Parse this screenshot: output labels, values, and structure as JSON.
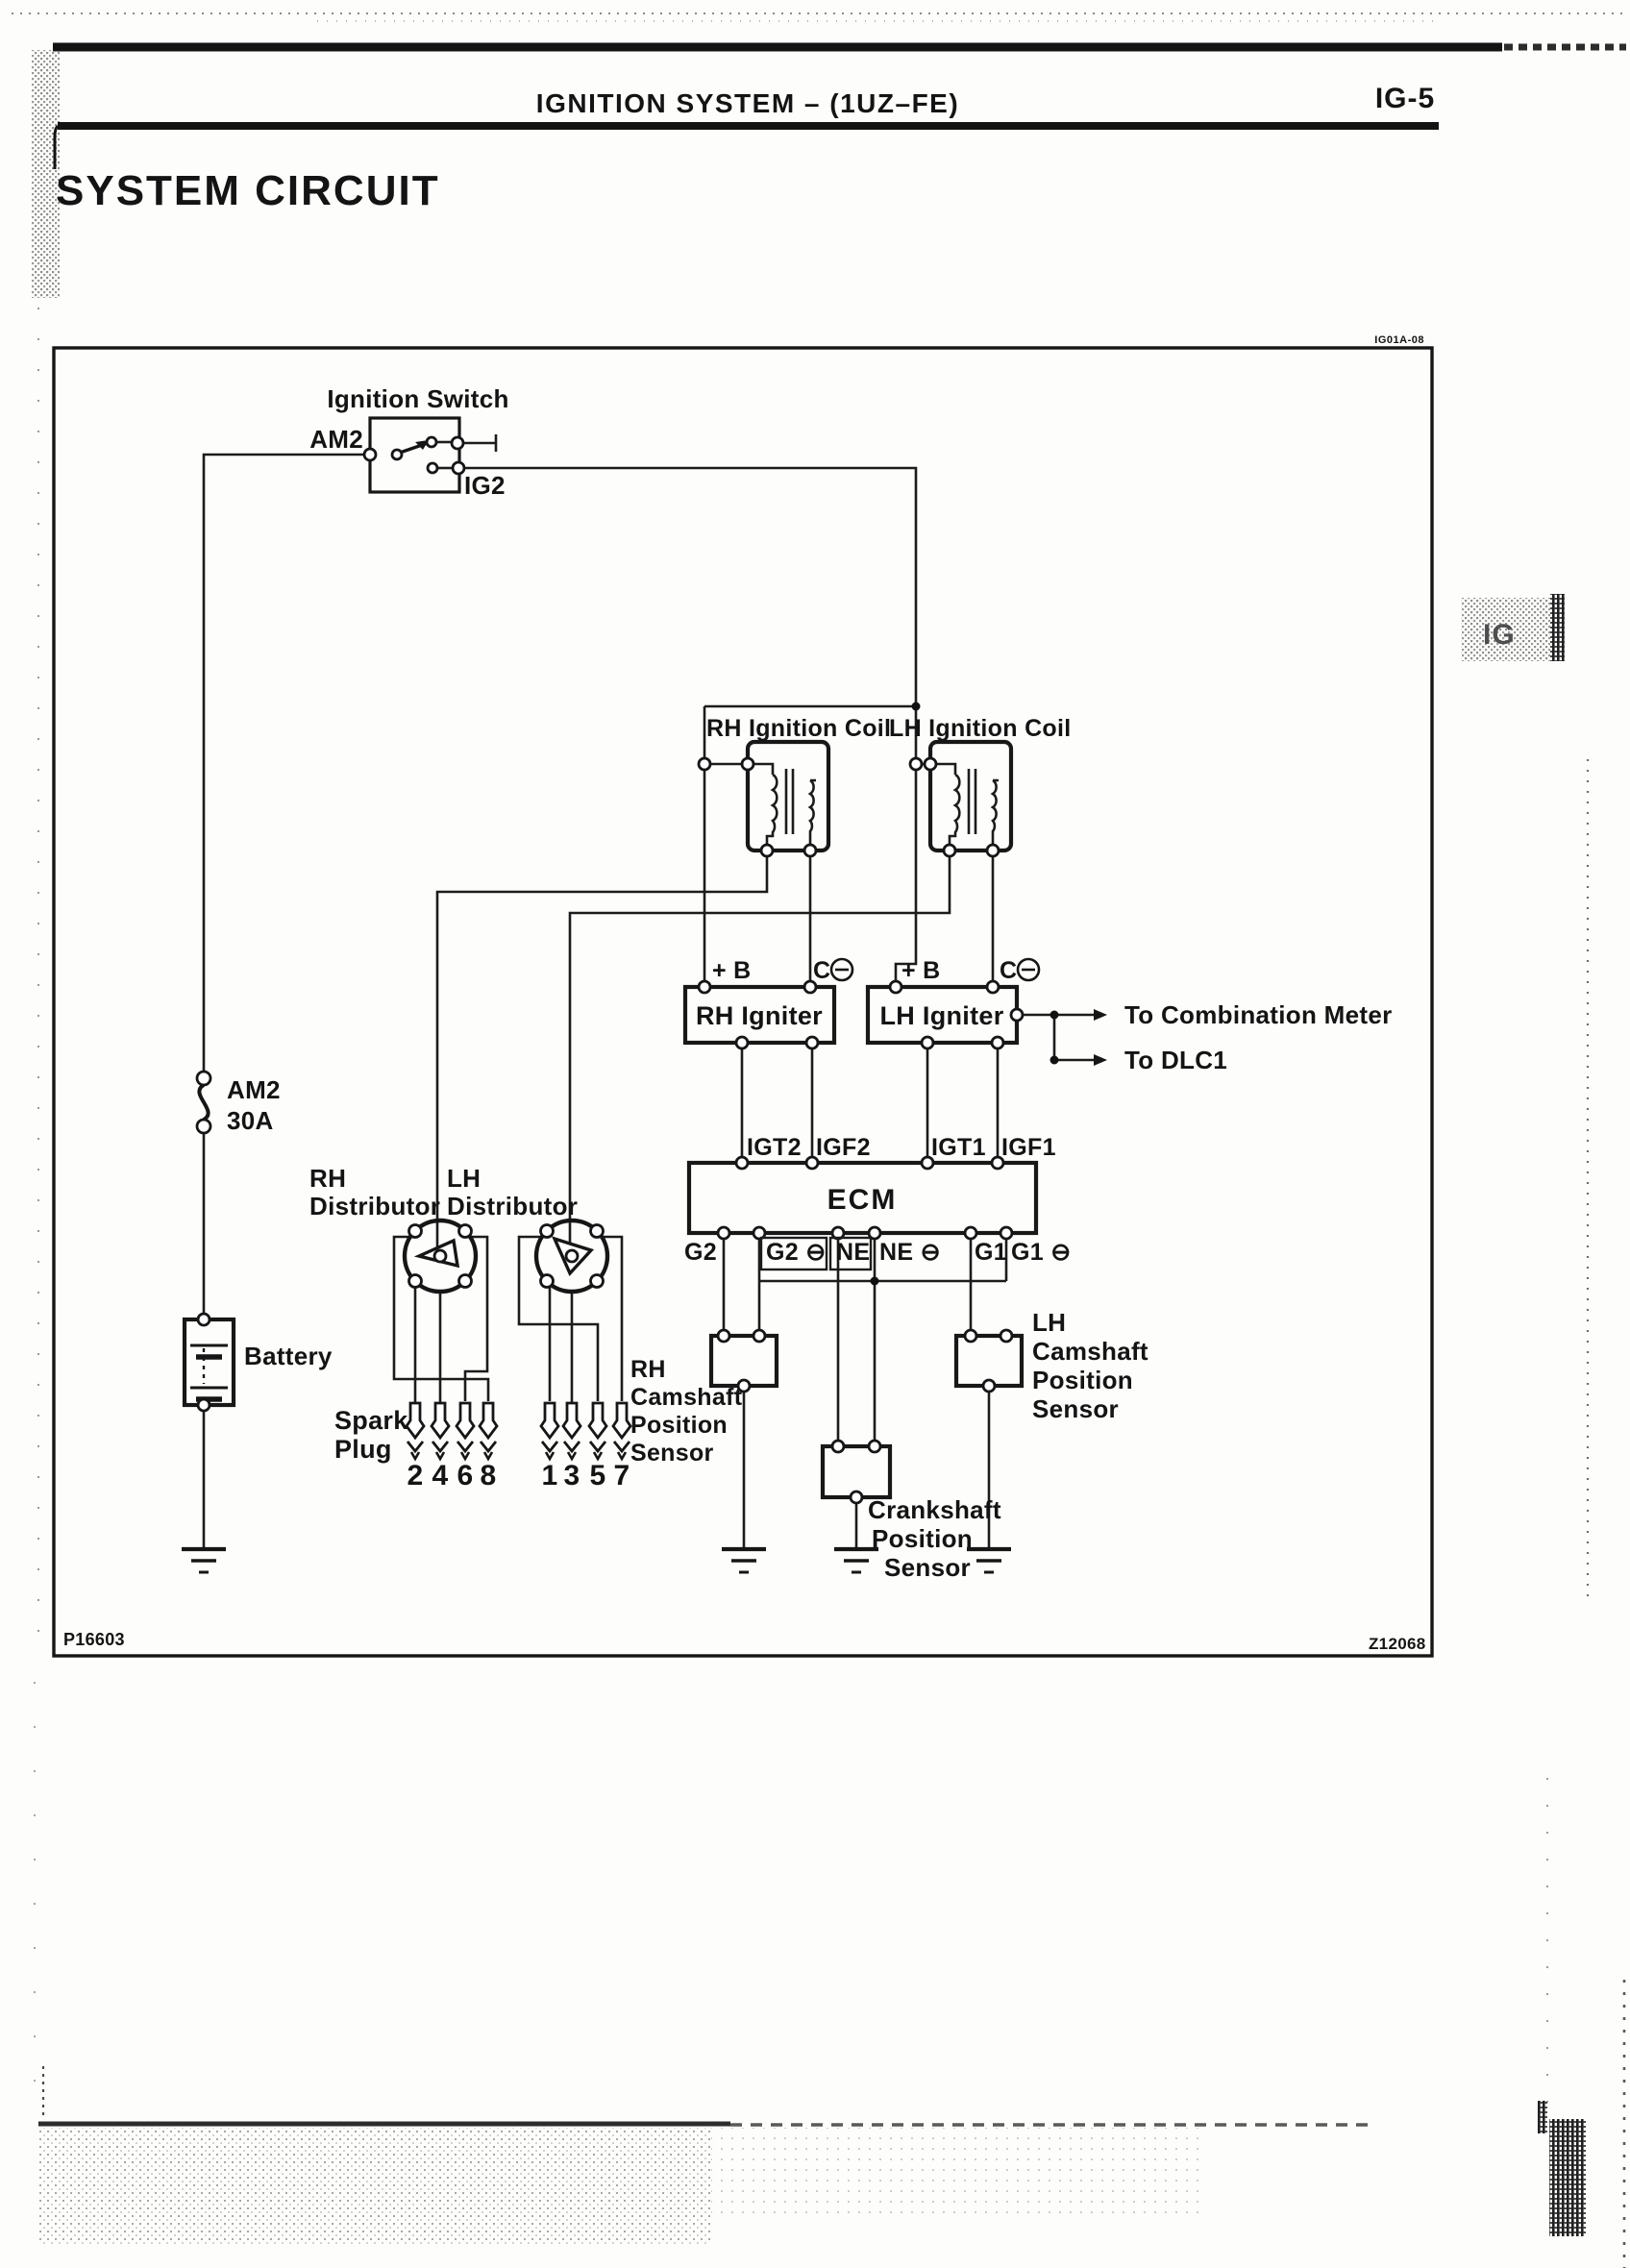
{
  "page": {
    "header_title": "IGNITION SYSTEM – (1UZ–FE)",
    "page_number": "IG-5",
    "section_title": "SYSTEM CIRCUIT",
    "side_tab": "IG",
    "diagram_code": "IG01A-08",
    "code_bottom_left": "P16603",
    "code_bottom_right": "Z12068"
  },
  "ignition_switch": {
    "label": "Ignition Switch",
    "terminal_am2": "AM2",
    "terminal_ig2": "IG2"
  },
  "fuse": {
    "name": "AM2",
    "rating": "30A"
  },
  "battery": {
    "label": "Battery"
  },
  "coils": {
    "rh": "RH Ignition Coil",
    "lh": "LH Ignition Coil"
  },
  "igniters": {
    "rh": "RH Igniter",
    "lh": "LH Igniter",
    "plus_b": "+ B",
    "c": "C",
    "to_combination_meter": "To Combination Meter",
    "to_dlc1": "To DLC1"
  },
  "ecm": {
    "label": "ECM",
    "top_pins": [
      "IGT2",
      "IGF2",
      "IGT1",
      "IGF1"
    ],
    "bottom_pins": [
      "G2",
      "G2 ⊖",
      "NE",
      "NE ⊖",
      "G1",
      "G1 ⊖"
    ]
  },
  "distributors": {
    "rh_line1": "RH",
    "rh_line2": "Distributor",
    "lh_line1": "LH",
    "lh_line2": "Distributor"
  },
  "spark_plugs": {
    "label_line1": "Spark",
    "label_line2": "Plug",
    "rh_numbers": [
      "2",
      "4",
      "6",
      "8"
    ],
    "lh_numbers": [
      "1",
      "3",
      "5",
      "7"
    ]
  },
  "sensors": {
    "rh_cam": [
      "RH",
      "Camshaft",
      "Position",
      "Sensor"
    ],
    "lh_cam": [
      "LH",
      "Camshaft",
      "Position",
      "Sensor"
    ],
    "crank": [
      "Crankshaft",
      "Position",
      "Sensor"
    ]
  }
}
